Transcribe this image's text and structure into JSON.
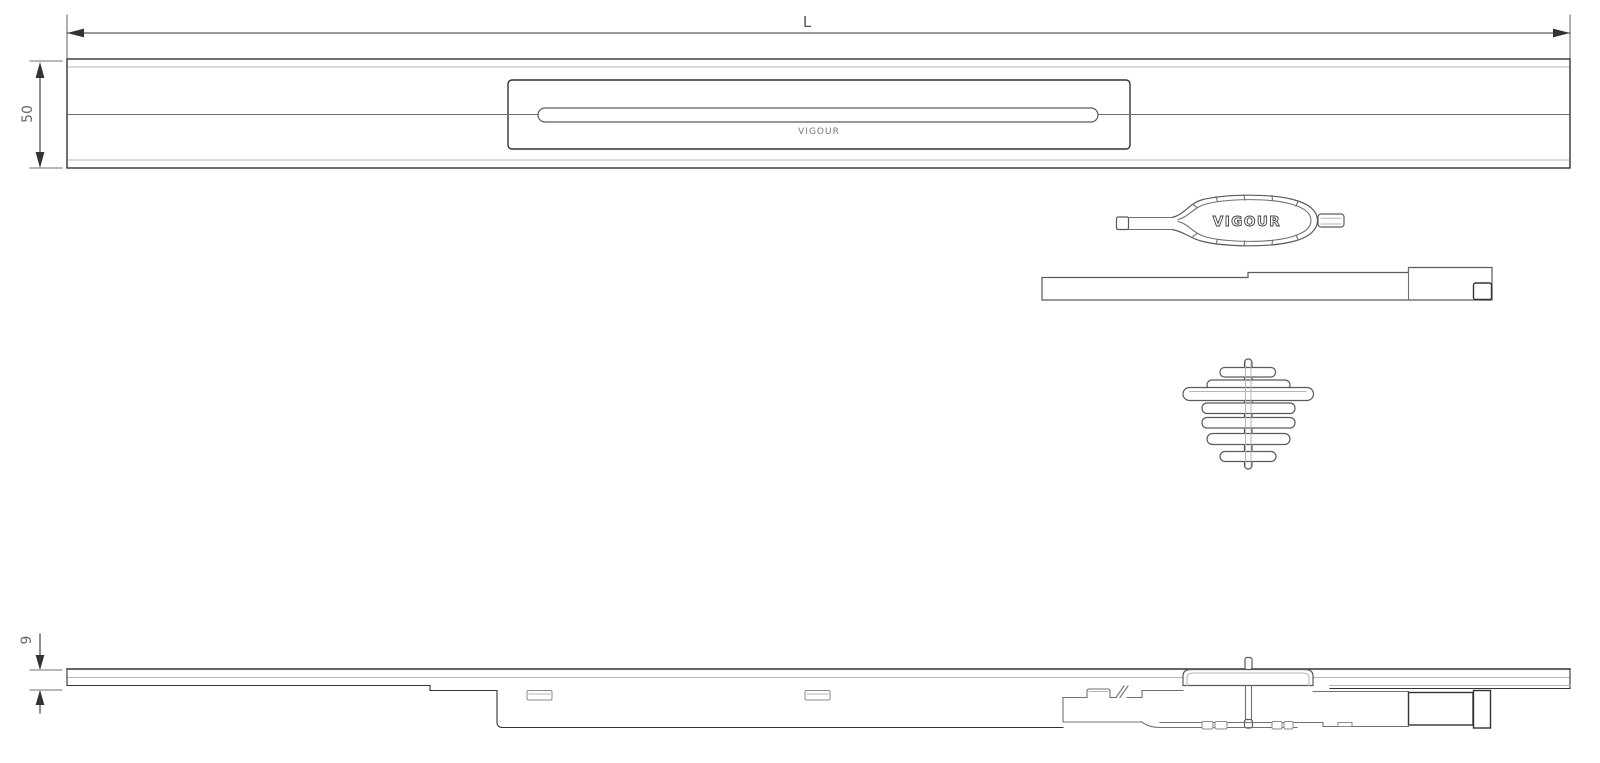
{
  "dimensions": {
    "length": {
      "label": "L"
    },
    "channel_width": {
      "label": "50"
    },
    "profile_height": {
      "label": "9"
    }
  },
  "branding": {
    "cover_plate": "VIGOUR",
    "service_key": "VIGOUR"
  },
  "colors": {
    "background": "#ffffff",
    "line_dark": "#333333",
    "line_medium": "#707070",
    "line_light": "#b5b5b5",
    "text": "#555555"
  }
}
